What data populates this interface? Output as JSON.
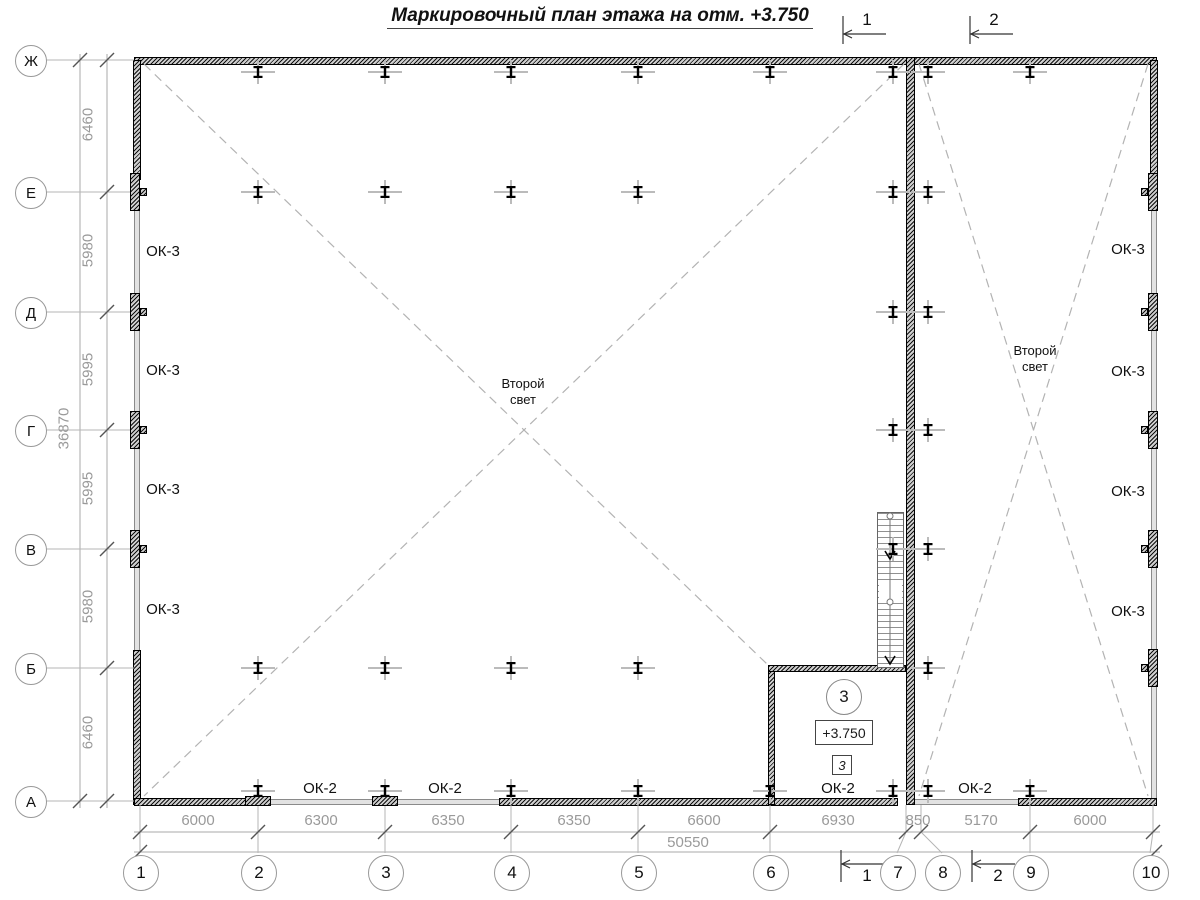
{
  "title": {
    "text": "Маркировочный план этажа на отм. +3.750"
  },
  "room": {
    "number": "3",
    "elevation": "+3.750",
    "door_mark": "3"
  },
  "annotations": {
    "second_light": [
      {
        "text": "Второй\nсвет",
        "cx": 523,
        "cy": 376
      },
      {
        "text": "Второй\nсвет",
        "cx": 1035,
        "cy": 343
      }
    ]
  },
  "window_labels": [
    {
      "text": "ОК-3",
      "cx": 163,
      "cy": 252
    },
    {
      "text": "ОК-3",
      "cx": 163,
      "cy": 371
    },
    {
      "text": "ОК-3",
      "cx": 163,
      "cy": 490
    },
    {
      "text": "ОК-3",
      "cx": 163,
      "cy": 610
    },
    {
      "text": "ОК-3",
      "cx": 1128,
      "cy": 250
    },
    {
      "text": "ОК-3",
      "cx": 1128,
      "cy": 372
    },
    {
      "text": "ОК-3",
      "cx": 1128,
      "cy": 492
    },
    {
      "text": "ОК-3",
      "cx": 1128,
      "cy": 612
    },
    {
      "text": "ОК-2",
      "cx": 320,
      "cy": 789
    },
    {
      "text": "ОК-2",
      "cx": 445,
      "cy": 789
    },
    {
      "text": "ОК-2",
      "cx": 838,
      "cy": 789
    },
    {
      "text": "ОК-2",
      "cx": 975,
      "cy": 789
    }
  ],
  "section_marks": {
    "top": [
      {
        "label": "1",
        "x": 843
      },
      {
        "label": "2",
        "x": 970
      }
    ],
    "bottom": [
      {
        "label": "1",
        "x": 841
      },
      {
        "label": "2",
        "x": 972
      }
    ]
  },
  "axes": {
    "rows": [
      {
        "label": "Ж",
        "y": 60
      },
      {
        "label": "Е",
        "y": 192
      },
      {
        "label": "Д",
        "y": 312
      },
      {
        "label": "Г",
        "y": 430
      },
      {
        "label": "В",
        "y": 549
      },
      {
        "label": "Б",
        "y": 668
      },
      {
        "label": "А",
        "y": 801
      }
    ],
    "cols": [
      {
        "label": "1",
        "x": 140,
        "cx": 140
      },
      {
        "label": "2",
        "x": 258,
        "cx": 258
      },
      {
        "label": "3",
        "x": 385,
        "cx": 385
      },
      {
        "label": "4",
        "x": 511,
        "cx": 511
      },
      {
        "label": "5",
        "x": 638,
        "cx": 638
      },
      {
        "label": "6",
        "x": 770,
        "cx": 770
      },
      {
        "label": "7",
        "x": 906,
        "cx": 897
      },
      {
        "label": "8",
        "x": 921,
        "cx": 942
      },
      {
        "label": "9",
        "x": 1030,
        "cx": 1030
      },
      {
        "label": "10",
        "x": 1153,
        "cx": 1150
      }
    ]
  },
  "dimensions": {
    "left_bays": [
      {
        "text": "6460",
        "cy": 126
      },
      {
        "text": "5980",
        "cy": 252
      },
      {
        "text": "5995",
        "cy": 371
      },
      {
        "text": "5995",
        "cy": 490
      },
      {
        "text": "5980",
        "cy": 608
      },
      {
        "text": "6460",
        "cy": 734
      }
    ],
    "left_total": {
      "text": "36870",
      "cy": 430
    },
    "bottom_bays": [
      {
        "text": "6000",
        "cx": 198
      },
      {
        "text": "6300",
        "cx": 321
      },
      {
        "text": "6350",
        "cx": 448
      },
      {
        "text": "6350",
        "cx": 574
      },
      {
        "text": "6600",
        "cx": 704
      },
      {
        "text": "6930",
        "cx": 838
      },
      {
        "text": "850",
        "cx": 918
      },
      {
        "text": "5170",
        "cx": 981
      },
      {
        "text": "6000",
        "cx": 1090
      }
    ],
    "bottom_total": {
      "text": "50550",
      "cx": 688
    }
  },
  "structure": {
    "columns": [
      {
        "cy": 72,
        "xs": [
          258,
          385,
          511,
          638,
          770,
          893,
          928,
          1030
        ]
      },
      {
        "cy": 192,
        "xs": [
          258,
          385,
          511,
          638,
          893,
          928
        ]
      },
      {
        "cy": 312,
        "xs": [
          893,
          928
        ]
      },
      {
        "cy": 430,
        "xs": [
          893,
          928
        ]
      },
      {
        "cy": 549,
        "xs": [
          893,
          928
        ]
      },
      {
        "cy": 668,
        "xs": [
          258,
          385,
          511,
          638,
          928
        ]
      },
      {
        "cy": 791,
        "xs": [
          258,
          385,
          511,
          638,
          770,
          893,
          928,
          1030
        ]
      }
    ],
    "pads_left_rows": [
      192,
      312,
      430,
      549
    ],
    "pads_right_rows": [
      192,
      312,
      430,
      549,
      668
    ],
    "pads_bottom_cols": [
      258,
      385
    ]
  },
  "colors": {
    "ink": "#1a1a1a",
    "line_gray": "#aaaaaa",
    "dim_text_gray": "#9a9a9a",
    "wall_fill": "#cfcfcf"
  }
}
